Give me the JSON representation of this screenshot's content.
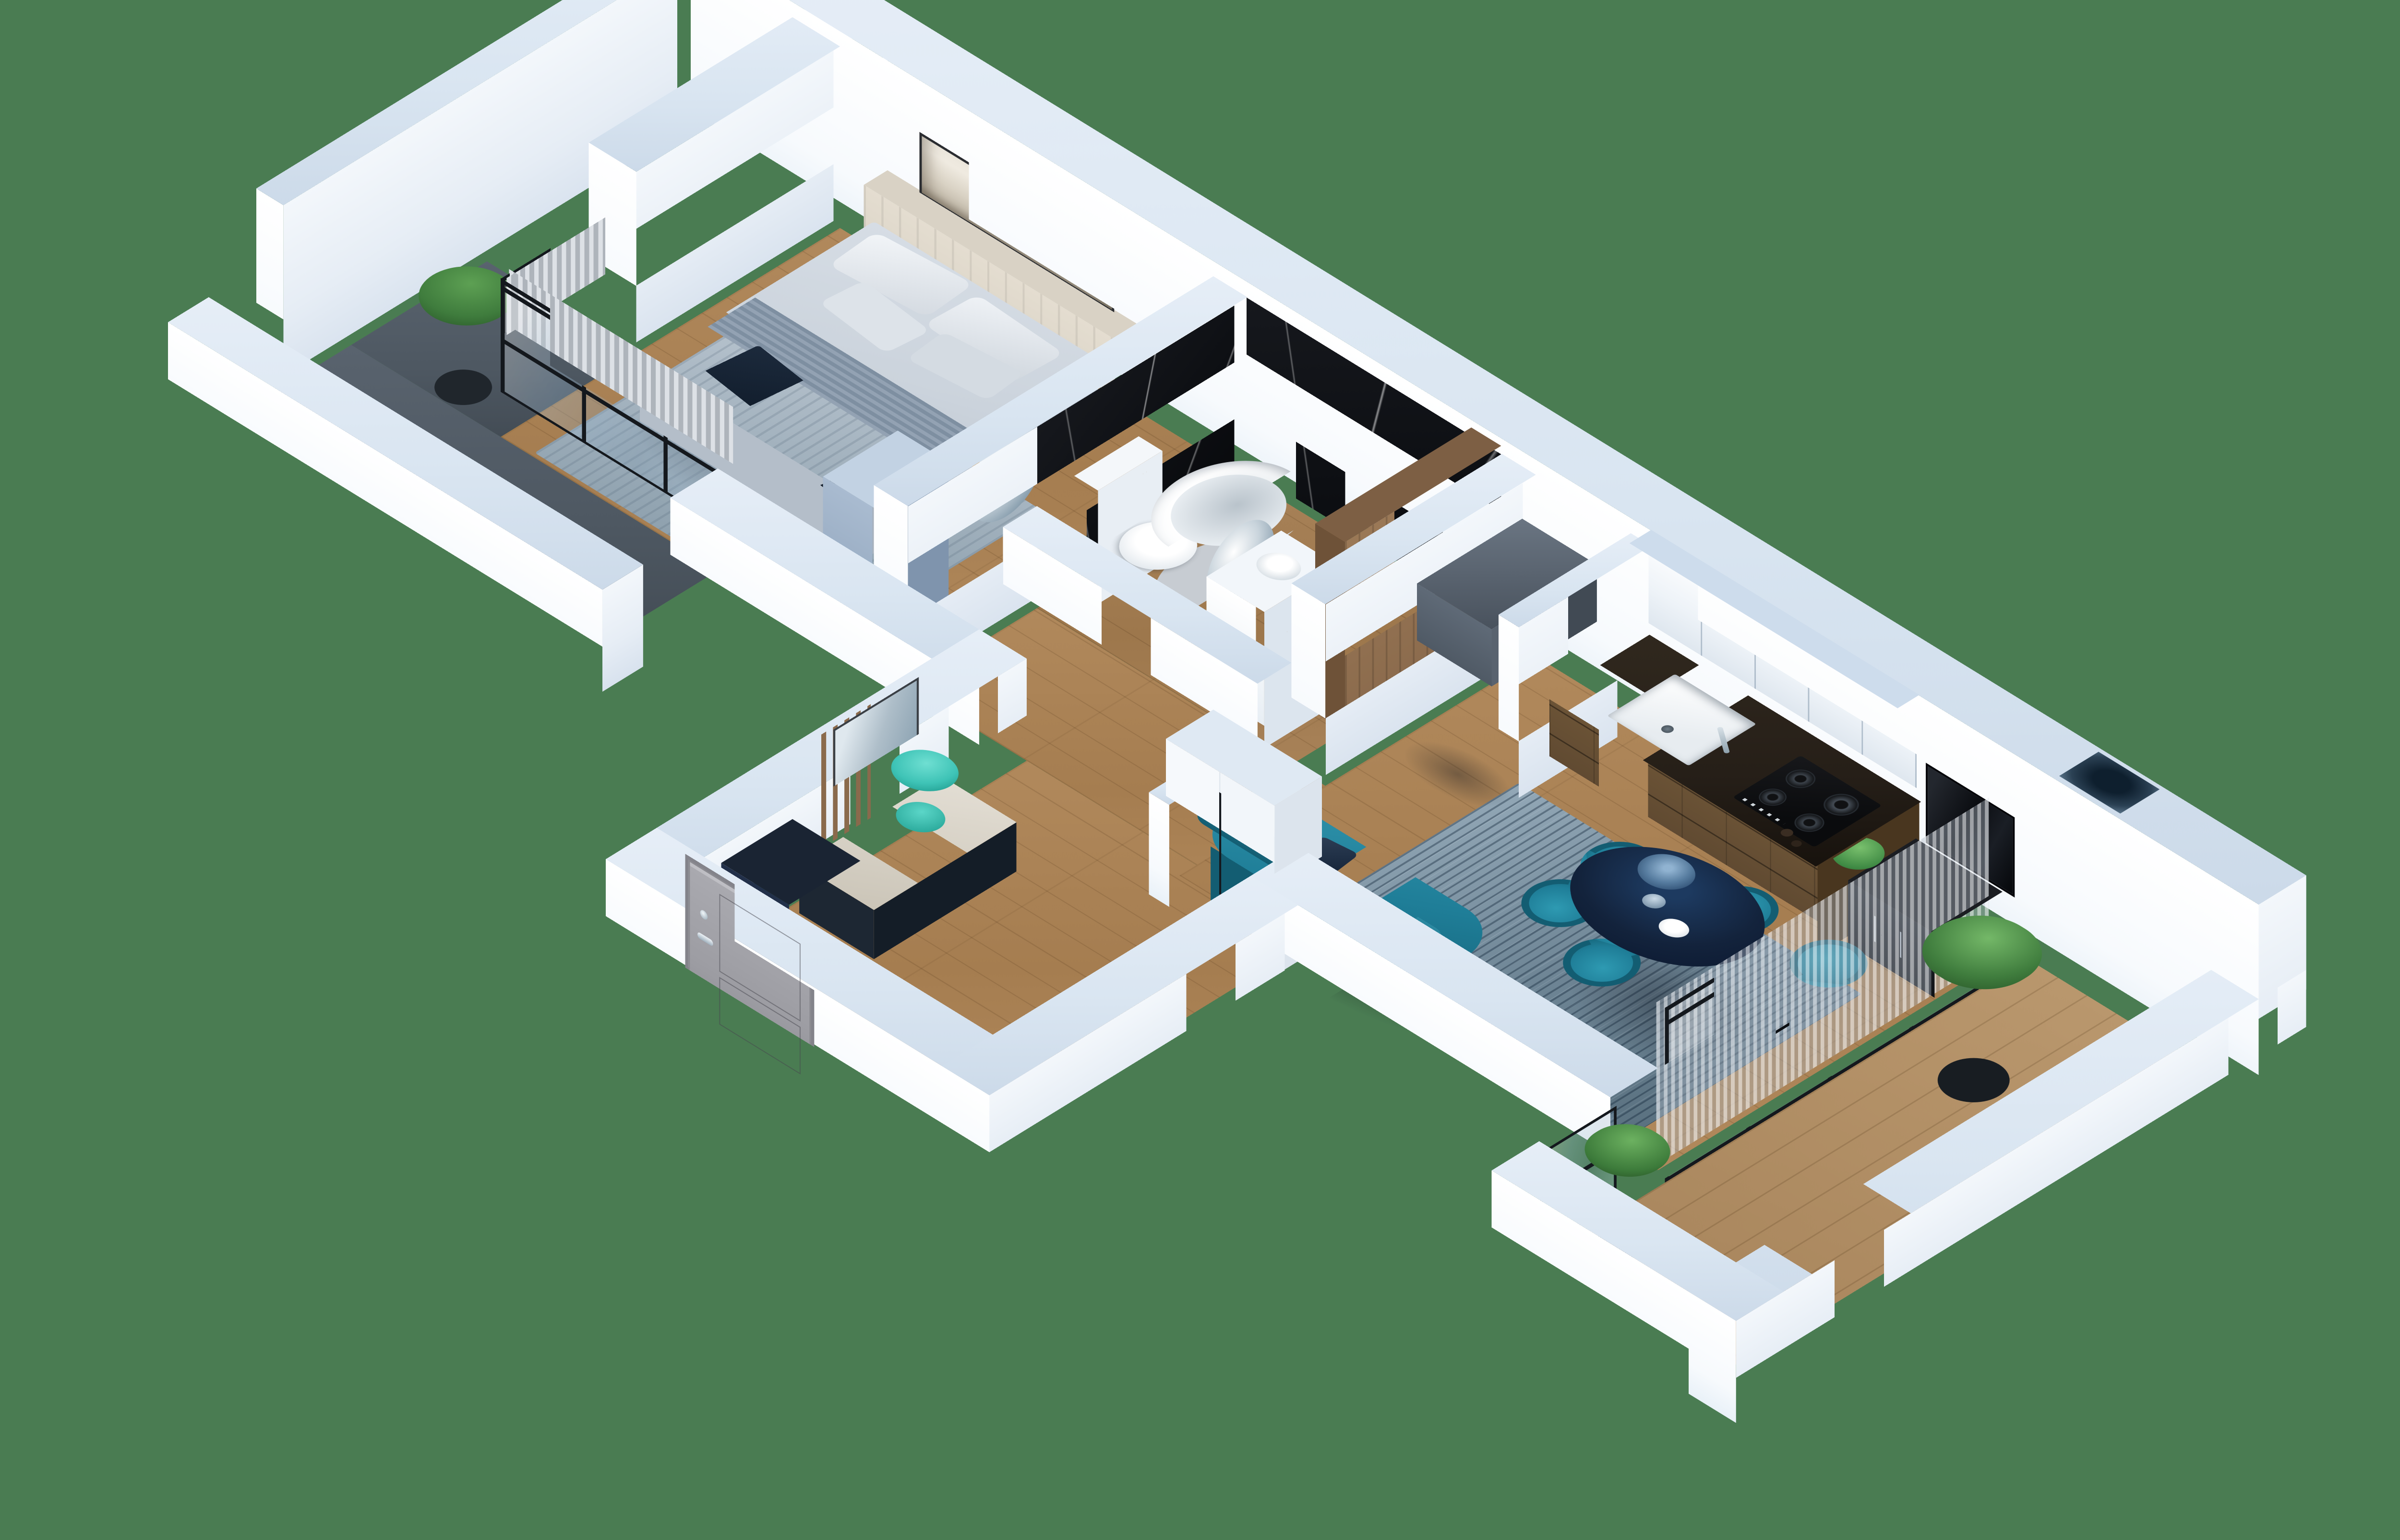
{
  "meta": {
    "scene": "isometric-3d-apartment-floor-plan-render",
    "view": "cutaway dollhouse, viewed from above at an angle",
    "background_color": "#4a7c52",
    "visible_text": ""
  },
  "palette": {
    "bg": "#4a7c52",
    "wallTop": "#d9e5f1",
    "wallFaceY": "#f7fafd",
    "wallFaceX": "#e6edf5",
    "wood": "#b1895c",
    "wood2": "#b9976d",
    "darkFloor": "#4e5862",
    "marble": "#0d0f13",
    "frame": "#14181d",
    "teal": "#1f7e98",
    "tealDark": "#135d72",
    "navy": "#13233c",
    "navyDark": "#0a1626",
    "graphite": "#4b5560",
    "beige": "#d9d2c5",
    "bedTop": "#cbd3dc",
    "bedFront": "#b4bec9",
    "curtain": "#c7ccd2",
    "doorGray": "#9d9da3",
    "woodPanel": "#8a6a4c",
    "cabinet": "#eef3f8",
    "cabinetTop": "#cddcec",
    "counterTop": "#261f18",
    "counterWood": "#5a452f",
    "green1": "#3f7c3d",
    "green2": "#5da053",
    "plantTeal": "#3ec3b6",
    "silver": "#c9d4dc"
  },
  "rooms": [
    {
      "name": "bedroom",
      "features": [
        "double-bed",
        "beige-headboard",
        "panoramic-artwork",
        "gray-rug",
        "curtains",
        "black-framed-corner-glazing",
        "vanity-desk",
        "round-mirror",
        "wood-chair",
        "blue-gray-wardrobe"
      ]
    },
    {
      "name": "bedroom-balcony",
      "features": [
        "dark-tile-floor",
        "green-shrub",
        "white-parapet"
      ]
    },
    {
      "name": "bathroom",
      "features": [
        "black-marble-walls",
        "freestanding-oval-tub",
        "leaning-round-mirror",
        "white-vanity-with-vessel-sink",
        "toilet",
        "tall-wood-panel"
      ]
    },
    {
      "name": "entry-hall",
      "features": [
        "gray-entry-door",
        "wood-slat-screen",
        "tall-mirror",
        "bench-with-cushion",
        "teal-plant",
        "navy-drawer-unit",
        "white-wardrobe"
      ]
    },
    {
      "name": "kitchen",
      "features": [
        "graphite-fridge",
        "dark-wood-base-cabinets",
        "white-sink",
        "gas-hob",
        "white-tall-upper-cabinets"
      ]
    },
    {
      "name": "living-dining",
      "features": [
        "teal-sofa",
        "blue-gray-rug",
        "navy-oval-dining-table",
        "five-teal-chairs",
        "eucalyptus-vase",
        "white-bowl",
        "tv-on-wall",
        "black-media-console",
        "potted-plant",
        "sheer-curtains"
      ]
    },
    {
      "name": "living-balcony",
      "features": [
        "black-framed-glass-partition-with-door",
        "wood-plank-floor",
        "two-green-shrubs",
        "ventilation-shaft",
        "glass-balustrade"
      ]
    }
  ]
}
